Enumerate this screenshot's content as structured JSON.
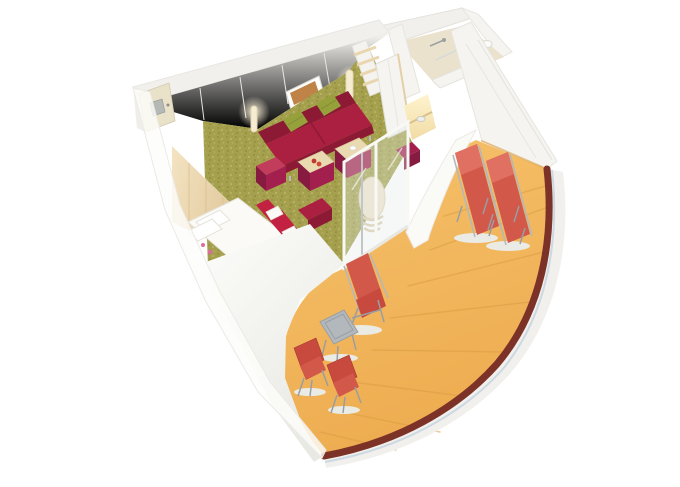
{
  "scene": {
    "title": "3D cutaway floor plan of a cruise-ship balcony cabin",
    "labels": {
      "cabin": "Cabin interior",
      "entrance_door": "Entrance door",
      "bathroom": "Bathroom with shower",
      "living_area": "Living area with carpet",
      "sofa": "Red sofa with green cushions",
      "cushion": "Green cushion",
      "artwork": "Framed wall artwork",
      "floor_lamp": "Floor lamp",
      "shelves": "Open wooden shelves",
      "wardrobe": "Wardrobe",
      "vanity": "Lighted vanity desk",
      "stool": "Red stool",
      "headboard": "Wooden headboard wall",
      "bed": "Double bed with red runners and towels",
      "bed_bench": "Red bench at bed foot",
      "ottoman_tray": "Ottoman with serving tray",
      "ottoman": "Red ottoman",
      "round_chair": "Round cream lounge chair",
      "sliding_door": "Sliding glass balcony door",
      "balcony": "Curved wrap-around balcony",
      "deck": "Wooden balcony deck",
      "railing": "Curved balcony railing",
      "partition": "Balcony partition wall",
      "loungers": "Two red sun loungers",
      "deck_chair": "Red reclining deck chair",
      "table": "Metal balcony table",
      "folding_chairs": "Two red folding chairs",
      "outer_wall": "Translucent outer cabin wall"
    }
  },
  "colors": {
    "background": "#ffffff",
    "wall": "#f5f4f0",
    "wall_top": "#f1f0ec",
    "wall_edge": "#e5e4de",
    "carpet": "#a5a04d",
    "wood": "#ead6ae",
    "door": "#e9e2c8",
    "door_plate": "#b5b9b5",
    "tile": "#ebe2cd",
    "sofa": "#ab1f40",
    "sofa_dark": "#8d1a34",
    "sofa_light": "#c23c5b",
    "cushion": "#97a13c",
    "ottoman": "#a31f4e",
    "ottoman_dark": "#871a41",
    "tray": "#e9dab2",
    "bed": "#fbfaf6",
    "runner": "#c32142",
    "deck": "#f3b95e",
    "deck_seam": "#dc9e44",
    "railing": "#7c3227",
    "glass_line": "#ccd8e2",
    "hull": "#f1f0ec",
    "lounger": "#d2584a",
    "lounger_light": "#e07162",
    "chair_red": "#c84a3f",
    "metal": "#b2b8bc",
    "metal_dark": "#989ea3",
    "lamp": "#f6ecd2",
    "art": "#bf8348",
    "front_band": "#f4f3ef",
    "translucent_wall": "rgba(252,252,250,0.82)",
    "glass": "rgba(226,234,231,0.35)",
    "shadow": "#ebebe6"
  }
}
